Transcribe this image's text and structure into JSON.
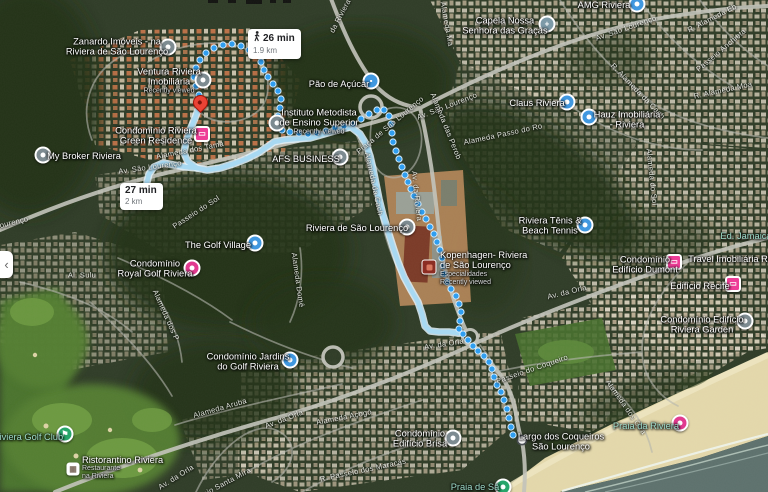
{
  "ui": {
    "panel_collapse": "‹"
  },
  "badges": {
    "walk26": {
      "time": "26 min",
      "distance": "1.9 km",
      "icon": "walking-person"
    },
    "walk27": {
      "time": "27 min",
      "distance": "2 km"
    }
  },
  "pois": [
    {
      "id": "zanardo-imoveis",
      "lines": [
        "Zanardo Imóveis - na",
        "Riviera de São Lourenço"
      ],
      "x": 117,
      "y": 47,
      "pin": {
        "shape": "circle",
        "color": "#7d8b91",
        "x": 168,
        "y": 47
      }
    },
    {
      "id": "ventura-riviera",
      "lines": [
        "Ventura Riviera",
        "Imobiliária"
      ],
      "sub": [
        "Recently viewed"
      ],
      "x": 169,
      "y": 81,
      "pin": {
        "shape": "circle",
        "color": "#7d8b91",
        "x": 203,
        "y": 80
      }
    },
    {
      "id": "riviera-green-residence",
      "lines": [
        "Condomínio Riviera",
        "Green Residence"
      ],
      "x": 156,
      "y": 136,
      "pin": {
        "shape": "square",
        "color": "#ee3d97",
        "glyph": "▭",
        "x": 202,
        "y": 134
      }
    },
    {
      "id": "my-broker-riviera",
      "lines": [
        "My Broker Riviera"
      ],
      "x": 84,
      "y": 156,
      "pin": {
        "shape": "circle",
        "color": "#7d8b91",
        "x": 43,
        "y": 155
      }
    },
    {
      "id": "pao-de-acucar",
      "lines": [
        "Pão de Açúcar"
      ],
      "x": 339,
      "y": 84,
      "pin": {
        "shape": "circle",
        "color": "#4198e0",
        "glyph": "▪",
        "x": 371,
        "y": 81
      }
    },
    {
      "id": "instituto-metodista",
      "lines": [
        "Instituto Metodista",
        "de Ensino Superior"
      ],
      "sub": [
        "Recently viewed"
      ],
      "x": 319,
      "y": 122,
      "pin": {
        "shape": "circle",
        "color": "#7d8b91",
        "x": 277,
        "y": 123
      }
    },
    {
      "id": "afs-business",
      "lines": [
        "AFS BUSINESS"
      ],
      "x": 306,
      "y": 159,
      "pin": {
        "shape": "circle",
        "color": "#7d8b91",
        "x": 340,
        "y": 157
      }
    },
    {
      "id": "capela-nossa-senhora",
      "lines": [
        "Capela Nossa",
        "Senhora das Graças"
      ],
      "x": 505,
      "y": 26,
      "pin": {
        "shape": "circle",
        "color": "#7d9aa8",
        "glyph": "+",
        "x": 547,
        "y": 24
      }
    },
    {
      "id": "claus-riviera",
      "lines": [
        "Claus Riviera"
      ],
      "x": 537,
      "y": 103,
      "pin": {
        "shape": "circle",
        "color": "#4198e0",
        "x": 567,
        "y": 102
      }
    },
    {
      "id": "amg-riviera",
      "lines": [
        "AMG Riviera"
      ],
      "x": 604,
      "y": 5,
      "pin": {
        "shape": "circle",
        "color": "#4198e0",
        "x": 637,
        "y": 4
      }
    },
    {
      "id": "hauz-imobiliaria",
      "lines": [
        "Hauz Imobiliária",
        "- Riviera"
      ],
      "x": 627,
      "y": 120,
      "pin": {
        "shape": "circle",
        "color": "#4198e0",
        "x": 589,
        "y": 117
      }
    },
    {
      "id": "riviera-de-sao-lourenco",
      "lines": [
        "Riviera de São Lourenço"
      ],
      "x": 357,
      "y": 228,
      "pin": {
        "shape": "circle",
        "color": "#7d8b91",
        "x": 407,
        "y": 227
      }
    },
    {
      "id": "riviera-tenis",
      "lines": [
        "Riviera Tênis &",
        "Beach Tennis"
      ],
      "x": 550,
      "y": 226,
      "pin": {
        "shape": "circle",
        "color": "#4198e0",
        "x": 585,
        "y": 225
      }
    },
    {
      "id": "kopenhagen-riviera",
      "align": "left",
      "lines": [
        "Kopenhagen- Riviera",
        "de São Lourenço"
      ],
      "sub": [
        "Especialidades",
        "Recently viewed"
      ],
      "x": 440,
      "y": 268,
      "pin": {
        "shape": "kopenhagen",
        "color": "#8c2d23",
        "x": 429,
        "y": 267
      }
    },
    {
      "id": "royal-golf-riviera",
      "lines": [
        "Condomínio",
        "Royal Golf Riviera"
      ],
      "x": 155,
      "y": 269,
      "pin": {
        "shape": "circle",
        "color": "#e13a8f",
        "x": 192,
        "y": 268
      }
    },
    {
      "id": "the-golf-village",
      "lines": [
        "The Golf Village"
      ],
      "x": 218,
      "y": 245,
      "pin": {
        "shape": "circle",
        "color": "#4198e0",
        "x": 255,
        "y": 243
      }
    },
    {
      "id": "jardins-do-golf",
      "lines": [
        "Condomínio Jardins",
        "do Golf Riviera"
      ],
      "x": 248,
      "y": 362,
      "pin": {
        "shape": "circle",
        "color": "#4198e0",
        "x": 290,
        "y": 360
      }
    },
    {
      "id": "edificio-dumont",
      "lines": [
        "Condomínio",
        "Edifício Dumont"
      ],
      "x": 645,
      "y": 265,
      "pin": {
        "shape": "square",
        "color": "#ee3d97",
        "glyph": "▭",
        "x": 674,
        "y": 262
      }
    },
    {
      "id": "edificio-recife",
      "lines": [
        "Edifício Recife"
      ],
      "x": 700,
      "y": 286,
      "pin": {
        "shape": "square",
        "color": "#ee3d97",
        "glyph": "▭",
        "x": 733,
        "y": 284
      }
    },
    {
      "id": "travel-imobiliaria",
      "lines": [
        "Travel Imobiliária Rivie"
      ],
      "x": 735,
      "y": 259
    },
    {
      "id": "ed-jamaica",
      "style": "nature",
      "lines": [
        "Ed. Jamaica"
      ],
      "x": 746,
      "y": 236
    },
    {
      "id": "riviera-garden",
      "lines": [
        "Condomínio Edifício",
        "Riviera Garden"
      ],
      "x": 702,
      "y": 325,
      "pin": {
        "shape": "circle",
        "color": "#7d8b91",
        "x": 745,
        "y": 321
      }
    },
    {
      "id": "edificio-brisa",
      "lines": [
        "Condomínio",
        "Edifício Brisa"
      ],
      "x": 420,
      "y": 439,
      "pin": {
        "shape": "circle",
        "color": "#7d8b91",
        "x": 453,
        "y": 438
      }
    },
    {
      "id": "largo-dos-coqueiros",
      "lines": [
        "Largo dos Coqueiros",
        "São Lourenço"
      ],
      "x": 561,
      "y": 442
    },
    {
      "id": "praia-da-riviera",
      "style": "nature",
      "lines": [
        "Praia da Riviera"
      ],
      "x": 646,
      "y": 426,
      "pin": {
        "shape": "circle",
        "color": "#e13a8f",
        "x": 680,
        "y": 423
      }
    },
    {
      "id": "praia-de-sao",
      "style": "nature",
      "lines": [
        "Praia de Sã"
      ],
      "x": 475,
      "y": 487,
      "pin": {
        "shape": "circle",
        "color": "#27a56a",
        "x": 503,
        "y": 487
      }
    },
    {
      "id": "riviera-golf-club",
      "style": "nature",
      "lines": [
        "Riviera Golf Club"
      ],
      "x": 28,
      "y": 437,
      "pin": {
        "shape": "circle",
        "color": "#27a56a",
        "glyph": "⚑",
        "x": 65,
        "y": 434
      }
    },
    {
      "id": "ristorantino-riviera",
      "align": "left",
      "lines": [
        "Ristorantino Riviera"
      ],
      "sub": [
        "Restaurante",
        "na Riviera"
      ],
      "x": 82,
      "y": 468,
      "pin": {
        "shape": "restaurant",
        "glyph": "▦",
        "x": 73,
        "y": 469
      }
    }
  ],
  "streets": [
    {
      "text": "Av. São Lourenço",
      "x": 447,
      "y": 106,
      "rot": -21
    },
    {
      "text": "Av. São Lourenço",
      "x": 626,
      "y": 28,
      "rot": -19
    },
    {
      "text": "Av. São Lourenço",
      "x": 150,
      "y": 167,
      "rot": -8
    },
    {
      "text": "ourenço",
      "x": 14,
      "y": 222,
      "rot": -14
    },
    {
      "text": "Praça de São Lourenço",
      "x": 390,
      "y": 125,
      "rot": -40
    },
    {
      "text": "Alameda das Perob",
      "x": 446,
      "y": 126,
      "rot": 68
    },
    {
      "text": "Av. da Riviera",
      "x": 417,
      "y": 196,
      "rot": 84
    },
    {
      "text": "da Riviera",
      "x": 340,
      "y": 16,
      "rot": -62
    },
    {
      "text": "Alameda Ma",
      "x": 447,
      "y": 24,
      "rot": 80
    },
    {
      "text": "Alameda dos Tama",
      "x": 190,
      "y": 150,
      "rot": -11
    },
    {
      "text": "Alameda da Cach",
      "x": 374,
      "y": 184,
      "rot": 78
    },
    {
      "text": "Passeio do Sol",
      "x": 196,
      "y": 212,
      "rot": -33
    },
    {
      "text": "Av. da Orla",
      "x": 176,
      "y": 477,
      "rot": -32
    },
    {
      "text": "Av. da Orla",
      "x": 284,
      "y": 419,
      "rot": -21
    },
    {
      "text": "Av. da Orla",
      "x": 444,
      "y": 344,
      "rot": -9
    },
    {
      "text": "Av. da Orla",
      "x": 567,
      "y": 292,
      "rot": -14
    },
    {
      "text": "Alameda Aruba",
      "x": 220,
      "y": 408,
      "rot": -16
    },
    {
      "text": "Alameda Açogó",
      "x": 344,
      "y": 417,
      "rot": -11
    },
    {
      "text": "R. Passeio dos Maracás",
      "x": 363,
      "y": 470,
      "rot": -12
    },
    {
      "text": "Passeio Santa Míra",
      "x": 219,
      "y": 486,
      "rot": -28
    },
    {
      "text": "Passeio do Coqueiro",
      "x": 532,
      "y": 369,
      "rot": -19
    },
    {
      "text": "Alameda dos Gira",
      "x": 626,
      "y": 407,
      "rot": 55
    },
    {
      "text": "Alameda Domê",
      "x": 298,
      "y": 280,
      "rot": 82
    },
    {
      "text": "Alameda Passo do Ro",
      "x": 503,
      "y": 134,
      "rot": -12
    },
    {
      "text": "R. Alameda Eb",
      "x": 712,
      "y": 18,
      "rot": -27
    },
    {
      "text": "R. Alameda Moa",
      "x": 723,
      "y": 90,
      "rot": -12
    },
    {
      "text": "R. Alameda da Cach",
      "x": 638,
      "y": 91,
      "rot": 46
    },
    {
      "text": "Alameda do Sol",
      "x": 652,
      "y": 177,
      "rot": 84
    },
    {
      "text": "Al. Sulu",
      "x": 82,
      "y": 275,
      "rot": 0
    },
    {
      "text": "Passeio Anchieta",
      "x": 721,
      "y": 50,
      "rot": -40
    },
    {
      "text": "Alameda dos P",
      "x": 166,
      "y": 315,
      "rot": 66
    }
  ],
  "routes": {
    "selected": {
      "mode": "walking",
      "style": "dotted",
      "color": "#2f9ef0",
      "origin": {
        "x": 199,
        "y": 111
      },
      "destination": {
        "x": 522,
        "y": 440
      },
      "points": [
        [
          199,
          95
        ],
        [
          196,
          86
        ],
        [
          194,
          77
        ],
        [
          196,
          68
        ],
        [
          200,
          60
        ],
        [
          206,
          53
        ],
        [
          214,
          48
        ],
        [
          223,
          45
        ],
        [
          232,
          44
        ],
        [
          241,
          46
        ],
        [
          249,
          50
        ],
        [
          256,
          55
        ],
        [
          261,
          62
        ],
        [
          264,
          70
        ],
        [
          268,
          77
        ],
        [
          273,
          84
        ],
        [
          278,
          91
        ],
        [
          281,
          99
        ],
        [
          280,
          108
        ],
        [
          278,
          116
        ],
        [
          277,
          124
        ],
        [
          282,
          130
        ],
        [
          290,
          132
        ],
        [
          299,
          133
        ],
        [
          308,
          134
        ],
        [
          317,
          133
        ],
        [
          326,
          131
        ],
        [
          335,
          128
        ],
        [
          344,
          126
        ],
        [
          353,
          124
        ],
        [
          361,
          119
        ],
        [
          369,
          114
        ],
        [
          377,
          110
        ],
        [
          384,
          110
        ],
        [
          389,
          116
        ],
        [
          391,
          124
        ],
        [
          392,
          133
        ],
        [
          393,
          142
        ],
        [
          396,
          151
        ],
        [
          399,
          159
        ],
        [
          402,
          167
        ],
        [
          405,
          175
        ],
        [
          408,
          182
        ],
        [
          411,
          189
        ],
        [
          414,
          196
        ],
        [
          418,
          204
        ],
        [
          422,
          212
        ],
        [
          426,
          219
        ],
        [
          430,
          227
        ],
        [
          434,
          234
        ],
        [
          437,
          242
        ],
        [
          440,
          250
        ],
        [
          442,
          258
        ],
        [
          443,
          266
        ],
        [
          444,
          274
        ],
        [
          447,
          282
        ],
        [
          451,
          289
        ],
        [
          456,
          296
        ],
        [
          459,
          304
        ],
        [
          461,
          312
        ],
        [
          460,
          321
        ],
        [
          459,
          329
        ],
        [
          463,
          334
        ],
        [
          468,
          340
        ],
        [
          473,
          346
        ],
        [
          478,
          351
        ],
        [
          484,
          356
        ],
        [
          489,
          362
        ],
        [
          492,
          369
        ],
        [
          494,
          377
        ],
        [
          497,
          385
        ],
        [
          501,
          392
        ],
        [
          504,
          400
        ],
        [
          507,
          409
        ],
        [
          509,
          418
        ],
        [
          511,
          427
        ],
        [
          513,
          435
        ]
      ]
    },
    "alternate": {
      "style": "solid",
      "color": "#a8d9f2",
      "casing": "#e2f2fb",
      "segments": [
        [
          [
            199,
            107
          ],
          [
            195,
            118
          ],
          [
            190,
            130
          ],
          [
            186,
            142
          ],
          [
            184,
            153
          ],
          [
            188,
            162
          ],
          [
            197,
            168
          ],
          [
            207,
            170
          ],
          [
            220,
            168
          ],
          [
            233,
            164
          ],
          [
            246,
            159
          ],
          [
            258,
            153
          ],
          [
            267,
            147
          ],
          [
            274,
            142
          ],
          [
            284,
            140
          ],
          [
            296,
            139
          ],
          [
            310,
            138
          ],
          [
            324,
            134
          ],
          [
            338,
            130
          ],
          [
            351,
            127
          ],
          [
            360,
            134
          ],
          [
            366,
            144
          ],
          [
            370,
            156
          ],
          [
            373,
            169
          ],
          [
            376,
            184
          ],
          [
            379,
            199
          ],
          [
            383,
            215
          ],
          [
            388,
            231
          ],
          [
            393,
            247
          ],
          [
            398,
            262
          ],
          [
            404,
            277
          ],
          [
            411,
            290
          ],
          [
            418,
            302
          ],
          [
            422,
            314
          ],
          [
            425,
            326
          ],
          [
            430,
            331
          ],
          [
            439,
            332
          ],
          [
            449,
            332
          ],
          [
            459,
            333
          ]
        ],
        [
          [
            197,
            168
          ],
          [
            186,
            167
          ],
          [
            174,
            165
          ],
          [
            163,
            163
          ],
          [
            154,
            167
          ],
          [
            149,
            174
          ],
          [
            147,
            182
          ]
        ]
      ]
    }
  }
}
